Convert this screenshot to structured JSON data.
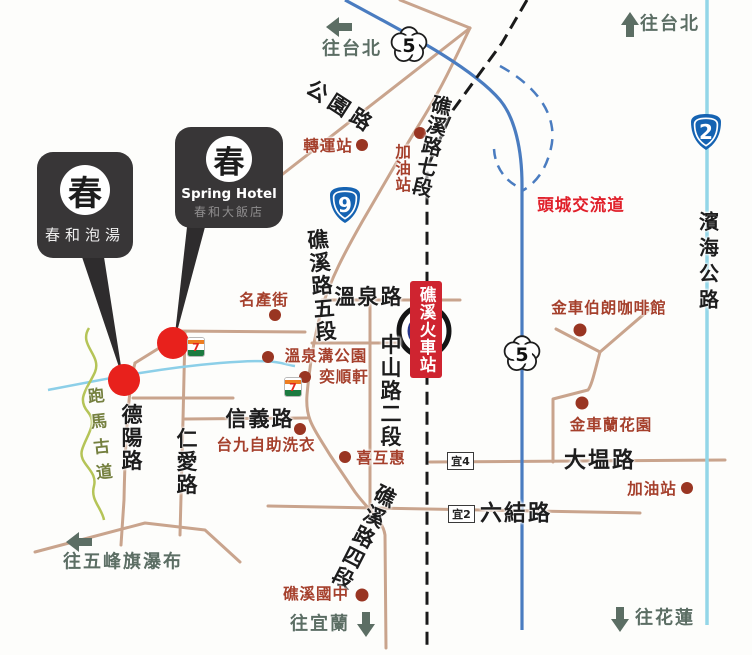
{
  "directions": {
    "taipei": "往台北",
    "yilan": "往宜蘭",
    "hualien": "往花蓮",
    "wufeng_falls": "往五峰旗瀑布"
  },
  "roads": {
    "gongyuan": "公園路",
    "jiaoxi_7": "礁溪路七段",
    "jiaoxi_5": "礁溪路五段",
    "jiaoxi_4": "礁溪路四段",
    "wenquan": "溫泉路",
    "zhongshan_2": "中山路二段",
    "xinyi": "信義路",
    "deyang": "德陽路",
    "renai": "仁愛路",
    "daweng": "大塭路",
    "liujie": "六結路",
    "binhai": "濱海公路",
    "paoma_trail": "跑馬古道"
  },
  "pois": {
    "transfer_station": "轉運站",
    "gas_station": "加油站",
    "mingchan_street": "名產街",
    "wenquangou_park": "溫泉溝公園",
    "yishunxuan": "奕順軒",
    "tai9_laundry": "台九自助洗衣",
    "xihuhui": "喜互惠",
    "jiaoxi_junior_high": "礁溪國中",
    "kingcar_coffee": "金車伯朗咖啡館",
    "kingcar_orchid": "金車蘭花園"
  },
  "station": {
    "name": "礁溪火車站"
  },
  "interchange": {
    "name": "頭城交流道"
  },
  "shields": {
    "provincial_9": "9",
    "provincial_2": "2",
    "freeway_5": "5"
  },
  "county_roads": {
    "yi4": "宜4",
    "yi2": "宜2"
  },
  "callouts": {
    "hot_spring": {
      "logo": "春",
      "label": "春和泡湯"
    },
    "hotel": {
      "logo": "春",
      "name_en": "Spring Hotel",
      "name_zh": "春和大飯店"
    }
  },
  "store": {
    "seven_eleven": "7"
  },
  "colors": {
    "road_tan": "#c9a48d",
    "freeway_blue": "#4a7cc0",
    "coastal_blue": "#93d6e8",
    "poi_red": "#a5402c",
    "highlight_red": "#e8211c",
    "banner_red": "#cf2430",
    "callout_black": "#383637",
    "trail_green": "#b5c457",
    "direction_gray": "#5c6e64"
  }
}
